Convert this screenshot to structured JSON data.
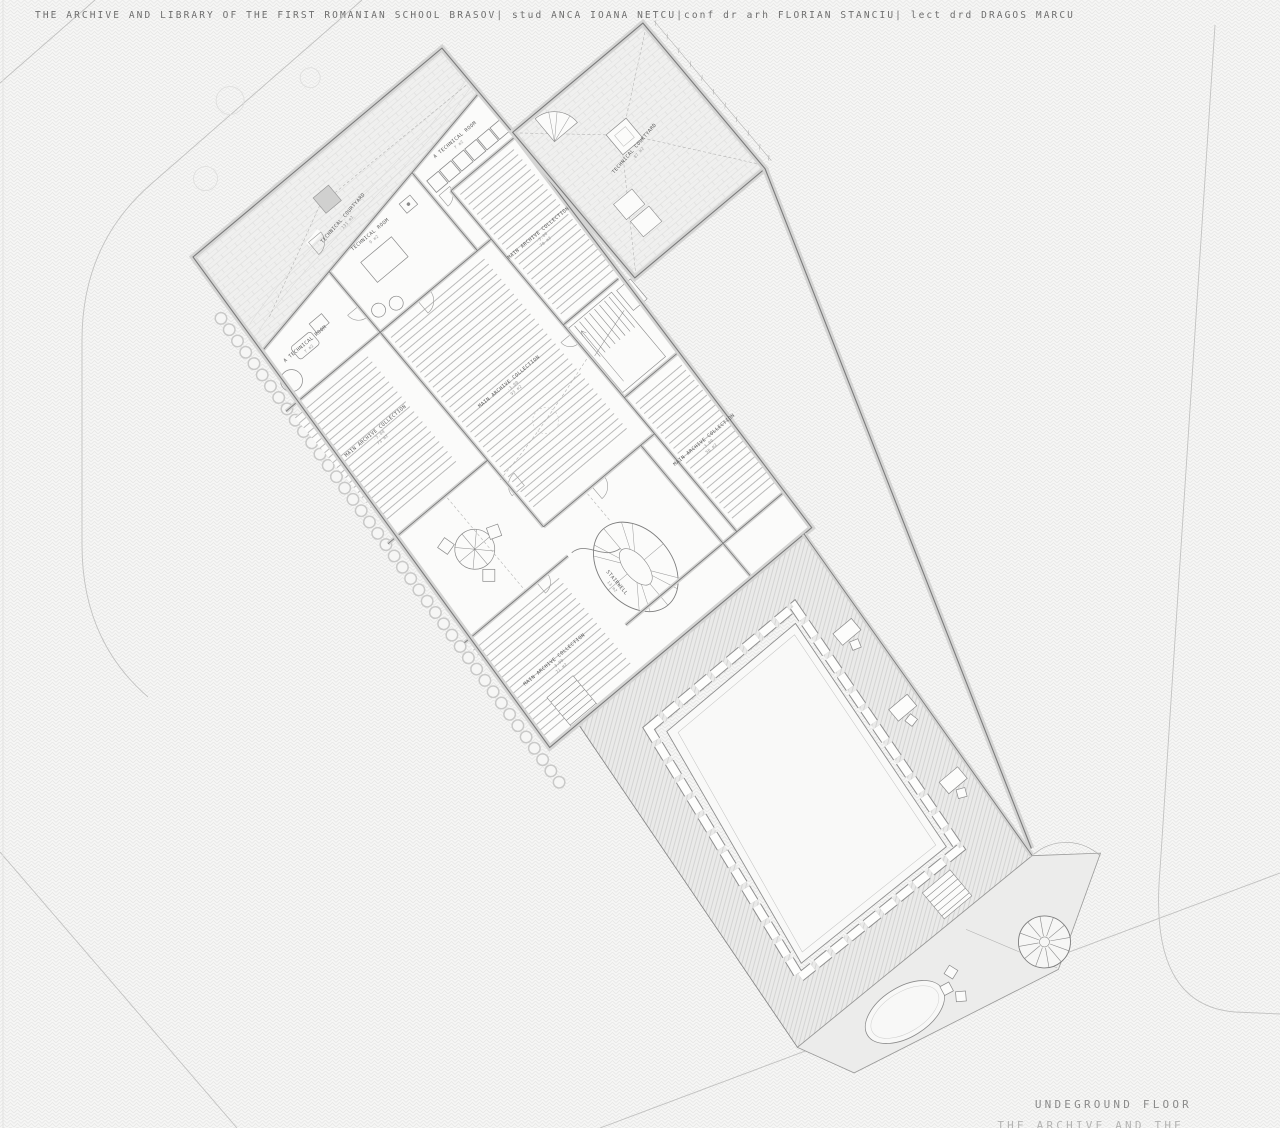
{
  "page": {
    "title": "THE ARCHIVE AND LIBRARY OF THE FIRST ROMANIAN SCHOOL BRASOV|  stud ANCA IOANA NETCU|conf dr arh FLORIAN STANCIU|  lect drd DRAGOS MARCU",
    "floor_label": "UNDEGROUND FLOOR",
    "floor_sublabel": "THE ARCHIVE AND THE"
  },
  "colors": {
    "background": "#f6f6f5",
    "background_hatch": "#e7e7e6",
    "ink": "#7b7b7b",
    "wall_fill": "#d4d4d3",
    "courtyard_hatch": "#cfcfce",
    "label_text": "#5c5c5c"
  },
  "rooms": [
    {
      "id": "technical-courtyard-main",
      "label": "TECHNICAL COURTYARD",
      "area": "131 m2"
    },
    {
      "id": "technical-room-a-left",
      "label": "A TECHNICAL ROOM",
      "area": "7 m2"
    },
    {
      "id": "technical-room",
      "label": "TECHNICAL ROOM",
      "area": "9 m2"
    },
    {
      "id": "technical-room-a-right",
      "label": "A TECHNICAL ROOM",
      "area": "7 m2"
    },
    {
      "id": "archive-collection-1",
      "label": "MAIN ARCHIVE COLLECTION",
      "level": "-3.00",
      "area": "73 m2"
    },
    {
      "id": "archive-collection-2",
      "label": "MAIN ARCHIVE COLLECTION",
      "level": "-3.00",
      "area": "93 m2"
    },
    {
      "id": "archive-collection-3",
      "label": "MAIN ARCHIVE COLLECTION",
      "level": "-3.00",
      "area": "78 m2"
    },
    {
      "id": "archive-collection-4",
      "label": "MAIN ARCHIVE COLLECTION",
      "level": "-3.00",
      "area": "71 m2"
    },
    {
      "id": "archive-collection-5",
      "label": "MAIN ARCHIVE COLLECTION",
      "level": "-3.00",
      "area": "58 m2"
    },
    {
      "id": "stairwell",
      "label": "STAIRWELL",
      "area": "13 m2"
    },
    {
      "id": "technical-courtyard-wing",
      "label": "TECHNICAL COURTYARD",
      "area": "87 m2"
    }
  ]
}
